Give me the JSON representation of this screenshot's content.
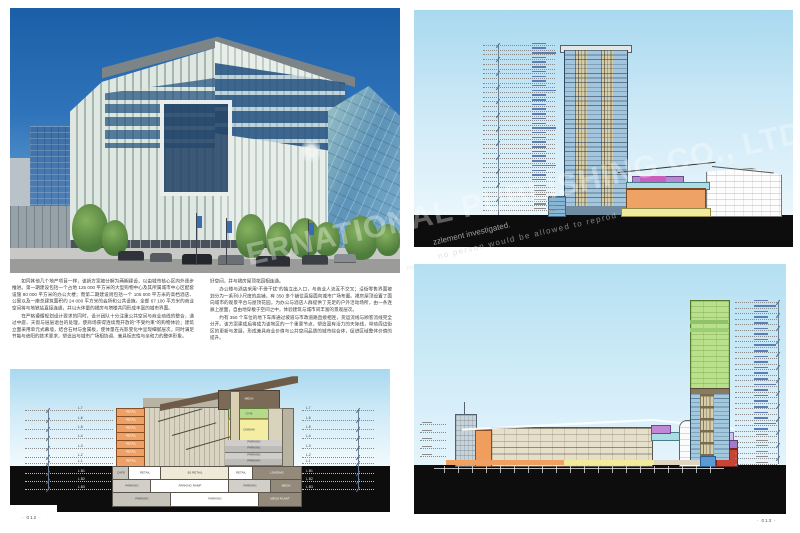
{
  "spread": {
    "left_page_number": "· 012 ·",
    "right_page_number": "· 013 ·"
  },
  "watermark": {
    "diagonal_text": "ERNATIONAL PUBLISHING CO., LTD.",
    "notice_line1": "zzlement investigated.",
    "notice_line2": "no person would be allowed to reprod",
    "notice_line3": "no pri"
  },
  "article": {
    "col1_paragraphs": [
      "如同其他几个地产项目一样，该新方案被分解为两期建设，以由城市核心区向外逐步推进。第一期建设包括一个占地 125 000 平方米的大型购物中心及其所属城市中心区配套设施 80 000 平方米的办公大楼；而第二期建设则包括一个 105 000 平方米的高档酒店、公寓以及一座总建筑面积约 24 000 平方米的会所和公共设施。全部 67 100 平方米的商业空间将与地铁站直接连通，并以大体量的裙房与塔楼共同形成丰富的城市界面。",
      "在严格遵循规划设计要求的同时，设计团队十分注重公共空间与商业动线的整合，通过中庭、天窗与层层退台的处理，使商场获得连续而开放的“不受约束”的购物体验；建筑立面采用单元式幕墙，结合石材与金属板，使体量在光影变化中呈现细腻层次，同时满足节能与遮阳的技术要求，塑造出与城市广场相协调、兼具标志性与亲和力的整体形象。"
    ],
    "col2_paragraphs": [
      "好空间，并与裙房屋顶花园相连通。",
      "办公楼与酒店采用“不受干扰”的独立出入口，与商业人流互不交叉；沿街零售界面被划分为一系列小尺度的店铺，有 350 多个铺位直接面向城市广场布置。裙房屋顶设置了面向城市的观景平台与屋顶花园，为办公与酒店人群提供了充足的户外活动场所，由一条连廊上屋面，自由地穿梭于空间之中，体验建筑与城市间丰富的景观层次。",
      "约有 350 个车位的地下车库通过坡道与市政道路直接相连，货运流线与顾客流线完全分开。该方案建成后将成为该地区的一个重要节点，塑造富有活力的天际线，带动周边街区的更新与发展，形成兼具商业价值与公共空间品质的城市综合体，促进区域整体价值的提升。"
    ]
  },
  "left_drawing": {
    "levels_above": [
      "L.7",
      "L.6",
      "L.5",
      "L.4",
      "L.3",
      "L.2",
      "L.1"
    ],
    "levels_below": [
      "L.B1",
      "L.B2",
      "L.B3"
    ],
    "retail_floors": [
      "RETAIL",
      "RETAIL",
      "RETAIL",
      "RETAIL",
      "RETAIL",
      "RETAIL",
      "RETAIL"
    ],
    "labels": {
      "mech": "MECH",
      "gym": "GYM",
      "cinema": "CINEMA"
    },
    "parking_rows": [
      "PARKING",
      "PARKING",
      "PARKING",
      "PARKING"
    ],
    "basement_rows": {
      "b1": [
        "CAFE",
        "RETAIL",
        "B1 RETAIL",
        "RETAIL",
        "LOADING"
      ],
      "b2": [
        "PARKING",
        "PARKING RAMP",
        "PARKING",
        "MECH"
      ],
      "b3": [
        "PARKING",
        "PARKING",
        "MECH PLANT"
      ]
    }
  },
  "right_top_drawing": {
    "tower_floor_lines": 30,
    "podium_floor_lines": 6
  },
  "right_bottom_drawing": {
    "tower_floor_lines": 24,
    "podium_floor_lines": 6
  }
}
